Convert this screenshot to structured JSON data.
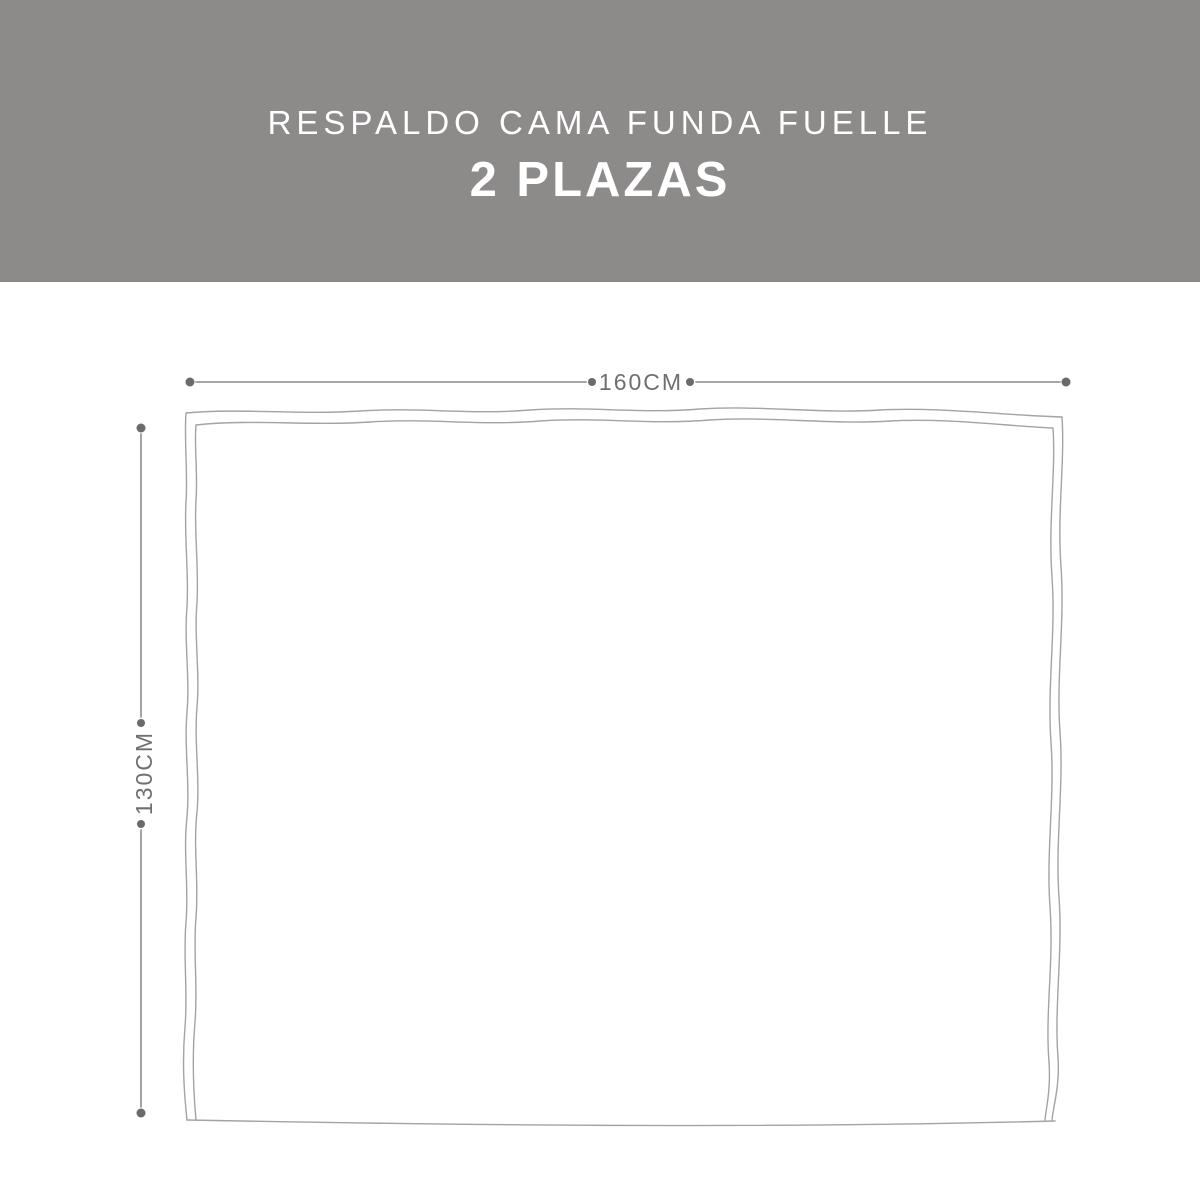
{
  "header": {
    "title": "RESPALDO CAMA FUNDA FUELLE",
    "subtitle": "2 PLAZAS",
    "background_color": "#8d8a8a",
    "text_color": "#ffffff"
  },
  "diagram": {
    "type": "product-dimension-diagram",
    "width_label": "160CM",
    "height_label": "130CM",
    "outline_color": "#a3a3a3",
    "dimension_line_color": "#9a9a9a",
    "dimension_dot_color": "#6b6b6b",
    "dimension_text_color": "#6f6f6f"
  }
}
